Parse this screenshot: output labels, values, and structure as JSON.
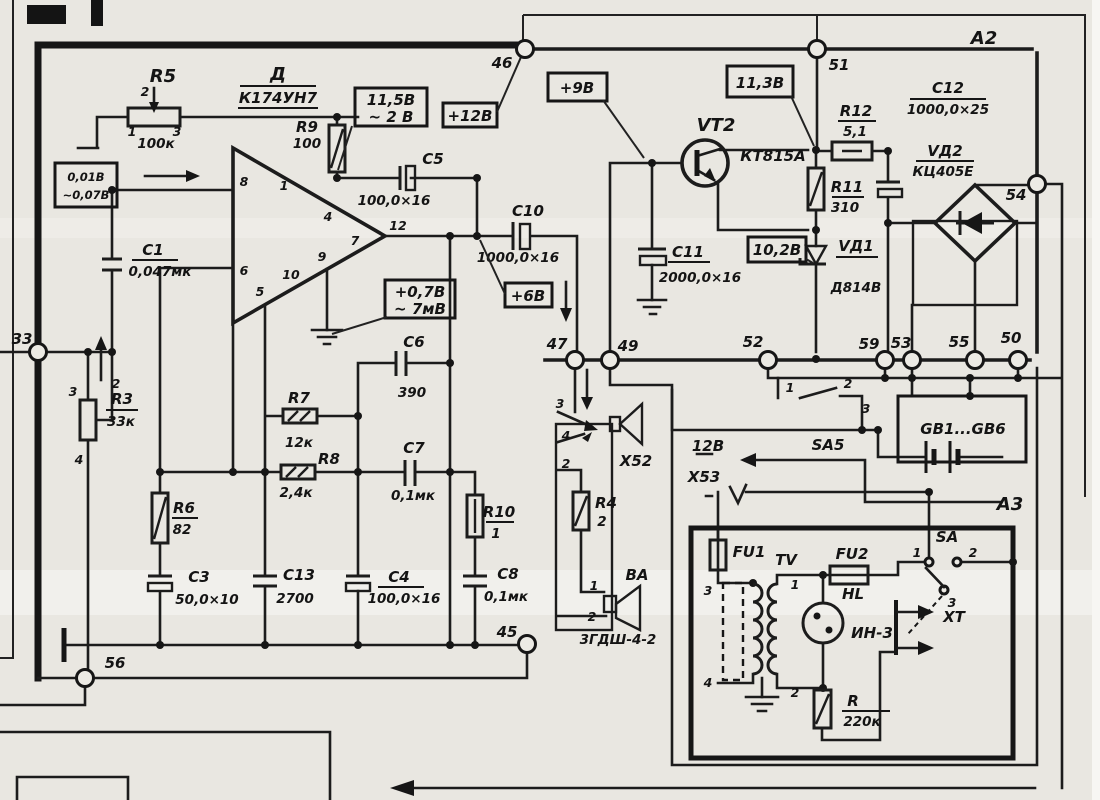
{
  "schematic": {
    "modules": {
      "a2": "А2",
      "a3": "А3"
    },
    "ic": {
      "des": "Д",
      "part": "К174УН7",
      "pins": {
        "p1": "1",
        "p4": "4",
        "p5": "5",
        "p6": "6",
        "p7": "7",
        "p8": "8",
        "p9": "9",
        "p10": "10",
        "p12": "12"
      }
    },
    "resistors": {
      "r3": {
        "des": "R3",
        "val": "33к",
        "p1": "3",
        "p2": "2",
        "p3": "4"
      },
      "r4": {
        "des": "R4",
        "val": "2"
      },
      "r5": {
        "des": "R5",
        "val": "100к",
        "p1": "1",
        "p2": "2",
        "p3": "3"
      },
      "r6": {
        "des": "R6",
        "val": "82"
      },
      "r7": {
        "des": "R7",
        "val": "12к"
      },
      "r8": {
        "des": "R8",
        "val": "2,4к"
      },
      "r9": {
        "des": "R9",
        "val": "100"
      },
      "r10": {
        "des": "R10",
        "val": "1"
      },
      "r11": {
        "des": "R11",
        "val": "310"
      },
      "r12": {
        "des": "R12",
        "val": "5,1"
      },
      "rp": {
        "des": "R",
        "val": "220к"
      }
    },
    "capacitors": {
      "c1": {
        "des": "С1",
        "val": "0,047мк"
      },
      "c3": {
        "des": "С3",
        "val": "50,0×10"
      },
      "c4": {
        "des": "С4",
        "val": "100,0×16"
      },
      "c5": {
        "des": "С5",
        "val": "100,0×16"
      },
      "c6": {
        "des": "С6",
        "val": "390"
      },
      "c7": {
        "des": "С7",
        "val": "0,1мк"
      },
      "c8": {
        "des": "С8",
        "val": "0,1мк"
      },
      "c10": {
        "des": "С10",
        "val": "1000,0×16"
      },
      "c11": {
        "des": "С11",
        "val": "2000,0×16"
      },
      "c12": {
        "des": "С12",
        "val": "1000,0×25"
      },
      "c13": {
        "des": "С13",
        "val": "2700"
      }
    },
    "semis": {
      "vt2": {
        "des": "VT2",
        "part": "КТ815А"
      },
      "vd1": {
        "des": "VД1",
        "part": "Д814В"
      },
      "vd2": {
        "des": "VД2",
        "part": "КЦ405Е"
      }
    },
    "voltages": {
      "input_dc": "0,01В",
      "input_ac": "~0,07В",
      "fb_dc": "11,5В",
      "fb_ac": "~ 2 В",
      "v12": "+12В",
      "v9": "+9В",
      "v6": "+6В",
      "out_dc": "+0,7В",
      "out_ac": "~ 7мВ",
      "v113": "11,3В",
      "v102": "10,2В"
    },
    "nodes": {
      "n33": "33",
      "n45": "45",
      "n46": "46",
      "n47": "47",
      "n49": "49",
      "n50": "50",
      "n51": "51",
      "n52": "52",
      "n53": "53",
      "n54": "54",
      "n55": "55",
      "n56": "56",
      "n59": "59"
    },
    "connectors": {
      "x52": {
        "des": "Х52",
        "p1": "3",
        "p2": "4",
        "p3": "2"
      },
      "x53": {
        "des": "Х53",
        "volt": "12В"
      },
      "xt": {
        "des": "ХТ"
      }
    },
    "speaker": {
      "des": "ВА",
      "part": "3ГДШ-4-2",
      "p1": "1",
      "p2": "2"
    },
    "switches": {
      "sa5": {
        "des": "SA5",
        "p1": "1",
        "p2": "2",
        "p3": "3"
      },
      "sa": {
        "des": "SA",
        "p1": "1",
        "p2": "2",
        "p3": "3"
      }
    },
    "battery": {
      "des": "GB1...GB6"
    },
    "psu": {
      "fu1": "FU1",
      "fu2": "FU2",
      "tv": {
        "des": "TV",
        "p1": "3",
        "p2": "4",
        "p3": "1",
        "p4": "2"
      },
      "hl": {
        "des": "HL",
        "part": "ИН-3"
      }
    }
  }
}
